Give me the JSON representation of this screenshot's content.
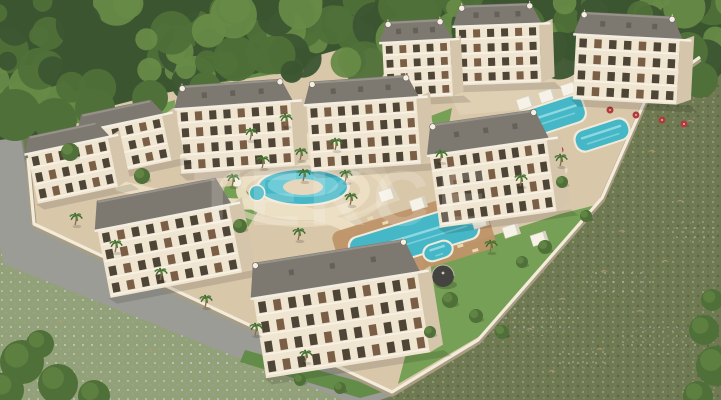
{
  "meta": {
    "description": "aerial 3d render of a gated residential complex with pools, surrounded by forest and flower meadows"
  },
  "scene": {
    "watermark": {
      "text": "TEKCE",
      "opacity": 0.17
    },
    "palette": {
      "forestDark": "#3b5531",
      "forest": "#4f7038",
      "forestLight": "#678a47",
      "meadowR": "#6f7a52",
      "meadowDot1": "#99a37c",
      "meadowDot2": "#55603e",
      "tuft": "#b49a6d",
      "flowerPatch": "#9aa4ae",
      "meadowB": "#93a178",
      "meadowBdot": "#ccd3e0",
      "road": "#9c9c96",
      "roadEdge": "#83837c",
      "ground": "#d9c7aa",
      "groundLight": "#e6d7bc",
      "path": "#ecdfc4",
      "lawn": "#76a055",
      "lawnDark": "#648c49",
      "wall": "#f3ecdb",
      "wallShadow": "#a89c82",
      "facade": "#efe5d1",
      "facadeSide": "#d4c5ab",
      "roof": "#7e7970",
      "roofDark": "#5f5b52",
      "roofLight": "#98938a",
      "window": "#4f4537",
      "window2": "#7a5f46",
      "rail": "#f8f3e8",
      "water": "#45b7c6",
      "waterLight": "#9adfe6",
      "poolRim": "#f1ead9",
      "deck": "#bf9468",
      "lounger": "#ead9b5",
      "cabana": "#f6f2e7",
      "cabanaSide": "#d8d2c2",
      "red": "#b03a3c",
      "trunk": "#8a6b4a",
      "palm": "#4e7d3a",
      "palmDark": "#3f6a2f",
      "dome": "#454340"
    },
    "buildings": [
      {
        "x": 575,
        "y": 14,
        "w": 104,
        "h": 88,
        "rf": 24,
        "fl": 4,
        "co": 7,
        "rot": 3,
        "orn": 1
      },
      {
        "x": 456,
        "y": 4,
        "w": 84,
        "h": 80,
        "rf": 22,
        "fl": 4,
        "co": 6,
        "rot": -2,
        "orn": 1
      },
      {
        "x": 383,
        "y": 20,
        "w": 68,
        "h": 78,
        "rf": 22,
        "fl": 4,
        "co": 5,
        "rot": -3,
        "orn": 1
      },
      {
        "x": 178,
        "y": 82,
        "w": 114,
        "h": 88,
        "rf": 24,
        "fl": 4,
        "co": 8,
        "rot": -4,
        "orn": 1
      },
      {
        "x": 308,
        "y": 78,
        "w": 110,
        "h": 90,
        "rf": 24,
        "fl": 4,
        "co": 8,
        "rot": -4,
        "orn": 1
      },
      {
        "x": 82,
        "y": 106,
        "w": 84,
        "h": 64,
        "rf": 18,
        "fl": 3,
        "co": 6,
        "rot": -12,
        "orn": 0
      },
      {
        "x": 30,
        "y": 128,
        "w": 82,
        "h": 68,
        "rf": 18,
        "fl": 3,
        "co": 6,
        "rot": -12,
        "orn": 0
      },
      {
        "x": 432,
        "y": 116,
        "w": 118,
        "h": 104,
        "rf": 32,
        "fl": 4,
        "co": 9,
        "rot": -8,
        "orn": 1
      },
      {
        "x": 100,
        "y": 188,
        "w": 134,
        "h": 98,
        "rf": 30,
        "fl": 4,
        "co": 9,
        "rot": -11,
        "orn": 0
      },
      {
        "x": 256,
        "y": 250,
        "w": 166,
        "h": 116,
        "rf": 36,
        "fl": 4,
        "co": 11,
        "rot": -9,
        "orn": 1
      }
    ],
    "pools": [
      {
        "cx": 414,
        "cy": 238,
        "w": 128,
        "h": 34,
        "rot": -17
      },
      {
        "cx": 547,
        "cy": 118,
        "w": 76,
        "h": 26,
        "rot": -18
      },
      {
        "cx": 602,
        "cy": 135,
        "w": 54,
        "h": 20,
        "rot": -18
      },
      {
        "cx": 438,
        "cy": 251,
        "w": 28,
        "h": 15,
        "rot": -18
      }
    ],
    "round_pool": {
      "cx": 303,
      "cy": 187,
      "rx": 44,
      "ry": 17
    },
    "spa": {
      "cx": 257,
      "cy": 193,
      "r": 7
    },
    "deck": {
      "cx": 414,
      "cy": 240,
      "w": 156,
      "h": 62,
      "rot": -17
    },
    "cabanas": [
      {
        "x": 378,
        "y": 192
      },
      {
        "x": 409,
        "y": 201
      },
      {
        "x": 440,
        "y": 210
      },
      {
        "x": 471,
        "y": 219
      },
      {
        "x": 502,
        "y": 228
      },
      {
        "x": 530,
        "y": 236
      },
      {
        "x": 516,
        "y": 100
      },
      {
        "x": 538,
        "y": 93
      },
      {
        "x": 560,
        "y": 86
      },
      {
        "x": 582,
        "y": 79
      }
    ],
    "dome": {
      "cx": 443,
      "cy": 276,
      "r": 11
    },
    "fountain": {
      "cx": 237,
      "cy": 182,
      "r": 5
    },
    "parasols": [
      {
        "x": 410,
        "y": 96
      },
      {
        "x": 433,
        "y": 90
      },
      {
        "x": 456,
        "y": 84
      },
      {
        "x": 480,
        "y": 78
      },
      {
        "x": 610,
        "y": 110
      },
      {
        "x": 636,
        "y": 115
      },
      {
        "x": 662,
        "y": 120
      },
      {
        "x": 684,
        "y": 124
      },
      {
        "x": 560,
        "y": 150
      },
      {
        "x": 540,
        "y": 158
      }
    ],
    "palms": [
      {
        "x": 250,
        "y": 140
      },
      {
        "x": 285,
        "y": 126
      },
      {
        "x": 335,
        "y": 150
      },
      {
        "x": 262,
        "y": 168
      },
      {
        "x": 300,
        "y": 160
      },
      {
        "x": 303,
        "y": 181
      },
      {
        "x": 350,
        "y": 205
      },
      {
        "x": 232,
        "y": 186
      },
      {
        "x": 298,
        "y": 240
      },
      {
        "x": 345,
        "y": 182
      },
      {
        "x": 490,
        "y": 252
      },
      {
        "x": 520,
        "y": 186
      },
      {
        "x": 560,
        "y": 166
      },
      {
        "x": 75,
        "y": 225
      },
      {
        "x": 115,
        "y": 252
      },
      {
        "x": 160,
        "y": 280
      },
      {
        "x": 205,
        "y": 307
      },
      {
        "x": 255,
        "y": 335
      },
      {
        "x": 305,
        "y": 362
      },
      {
        "x": 440,
        "y": 162
      }
    ],
    "trees": [
      {
        "x": 70,
        "y": 152,
        "r": 9
      },
      {
        "x": 142,
        "y": 176,
        "r": 8
      },
      {
        "x": 450,
        "y": 300,
        "r": 8
      },
      {
        "x": 476,
        "y": 316,
        "r": 7
      },
      {
        "x": 502,
        "y": 332,
        "r": 7
      },
      {
        "x": 430,
        "y": 332,
        "r": 6
      },
      {
        "x": 545,
        "y": 247,
        "r": 7
      },
      {
        "x": 522,
        "y": 262,
        "r": 6
      },
      {
        "x": 586,
        "y": 216,
        "r": 6
      },
      {
        "x": 240,
        "y": 226,
        "r": 7
      },
      {
        "x": 562,
        "y": 182,
        "r": 6
      },
      {
        "x": 340,
        "y": 388,
        "r": 6
      },
      {
        "x": 300,
        "y": 380,
        "r": 6
      }
    ],
    "corner_bushes": [
      {
        "x": 22,
        "y": 362,
        "r": 22
      },
      {
        "x": 58,
        "y": 384,
        "r": 20
      },
      {
        "x": 94,
        "y": 396,
        "r": 16
      },
      {
        "x": 6,
        "y": 390,
        "r": 18
      },
      {
        "x": 40,
        "y": 344,
        "r": 14
      },
      {
        "x": 704,
        "y": 330,
        "r": 15
      },
      {
        "x": 716,
        "y": 366,
        "r": 20
      },
      {
        "x": 698,
        "y": 396,
        "r": 15
      },
      {
        "x": 712,
        "y": 300,
        "r": 11
      }
    ],
    "tufts": [
      {
        "x": 530,
        "y": 330
      },
      {
        "x": 562,
        "y": 300
      },
      {
        "x": 600,
        "y": 350
      },
      {
        "x": 640,
        "y": 312
      },
      {
        "x": 665,
        "y": 262
      },
      {
        "x": 622,
        "y": 232
      },
      {
        "x": 680,
        "y": 202
      },
      {
        "x": 652,
        "y": 152
      },
      {
        "x": 690,
        "y": 122
      },
      {
        "x": 552,
        "y": 372
      },
      {
        "x": 512,
        "y": 292
      },
      {
        "x": 604,
        "y": 272
      },
      {
        "x": 118,
        "y": 300
      },
      {
        "x": 60,
        "y": 322
      },
      {
        "x": 150,
        "y": 352
      }
    ],
    "flower_patches": [
      {
        "x": 540,
        "y": 320,
        "rx": 40,
        "ry": 16
      },
      {
        "x": 620,
        "y": 282,
        "rx": 36,
        "ry": 14
      },
      {
        "x": 582,
        "y": 358,
        "rx": 30,
        "ry": 12
      },
      {
        "x": 660,
        "y": 340,
        "rx": 40,
        "ry": 15
      },
      {
        "x": 692,
        "y": 232,
        "rx": 26,
        "ry": 11
      },
      {
        "x": 120,
        "y": 310,
        "rx": 40,
        "ry": 14
      },
      {
        "x": 70,
        "y": 340,
        "rx": 30,
        "ry": 12
      },
      {
        "x": 200,
        "y": 360,
        "rx": 36,
        "ry": 13
      }
    ],
    "paths": [
      "M120,186 Q200,206 258,204",
      "M258,204 Q330,214 352,230",
      "M300,168 Q312,128 332,104",
      "M470,206 Q520,190 562,170",
      "M150,240 Q210,252 248,262"
    ]
  }
}
